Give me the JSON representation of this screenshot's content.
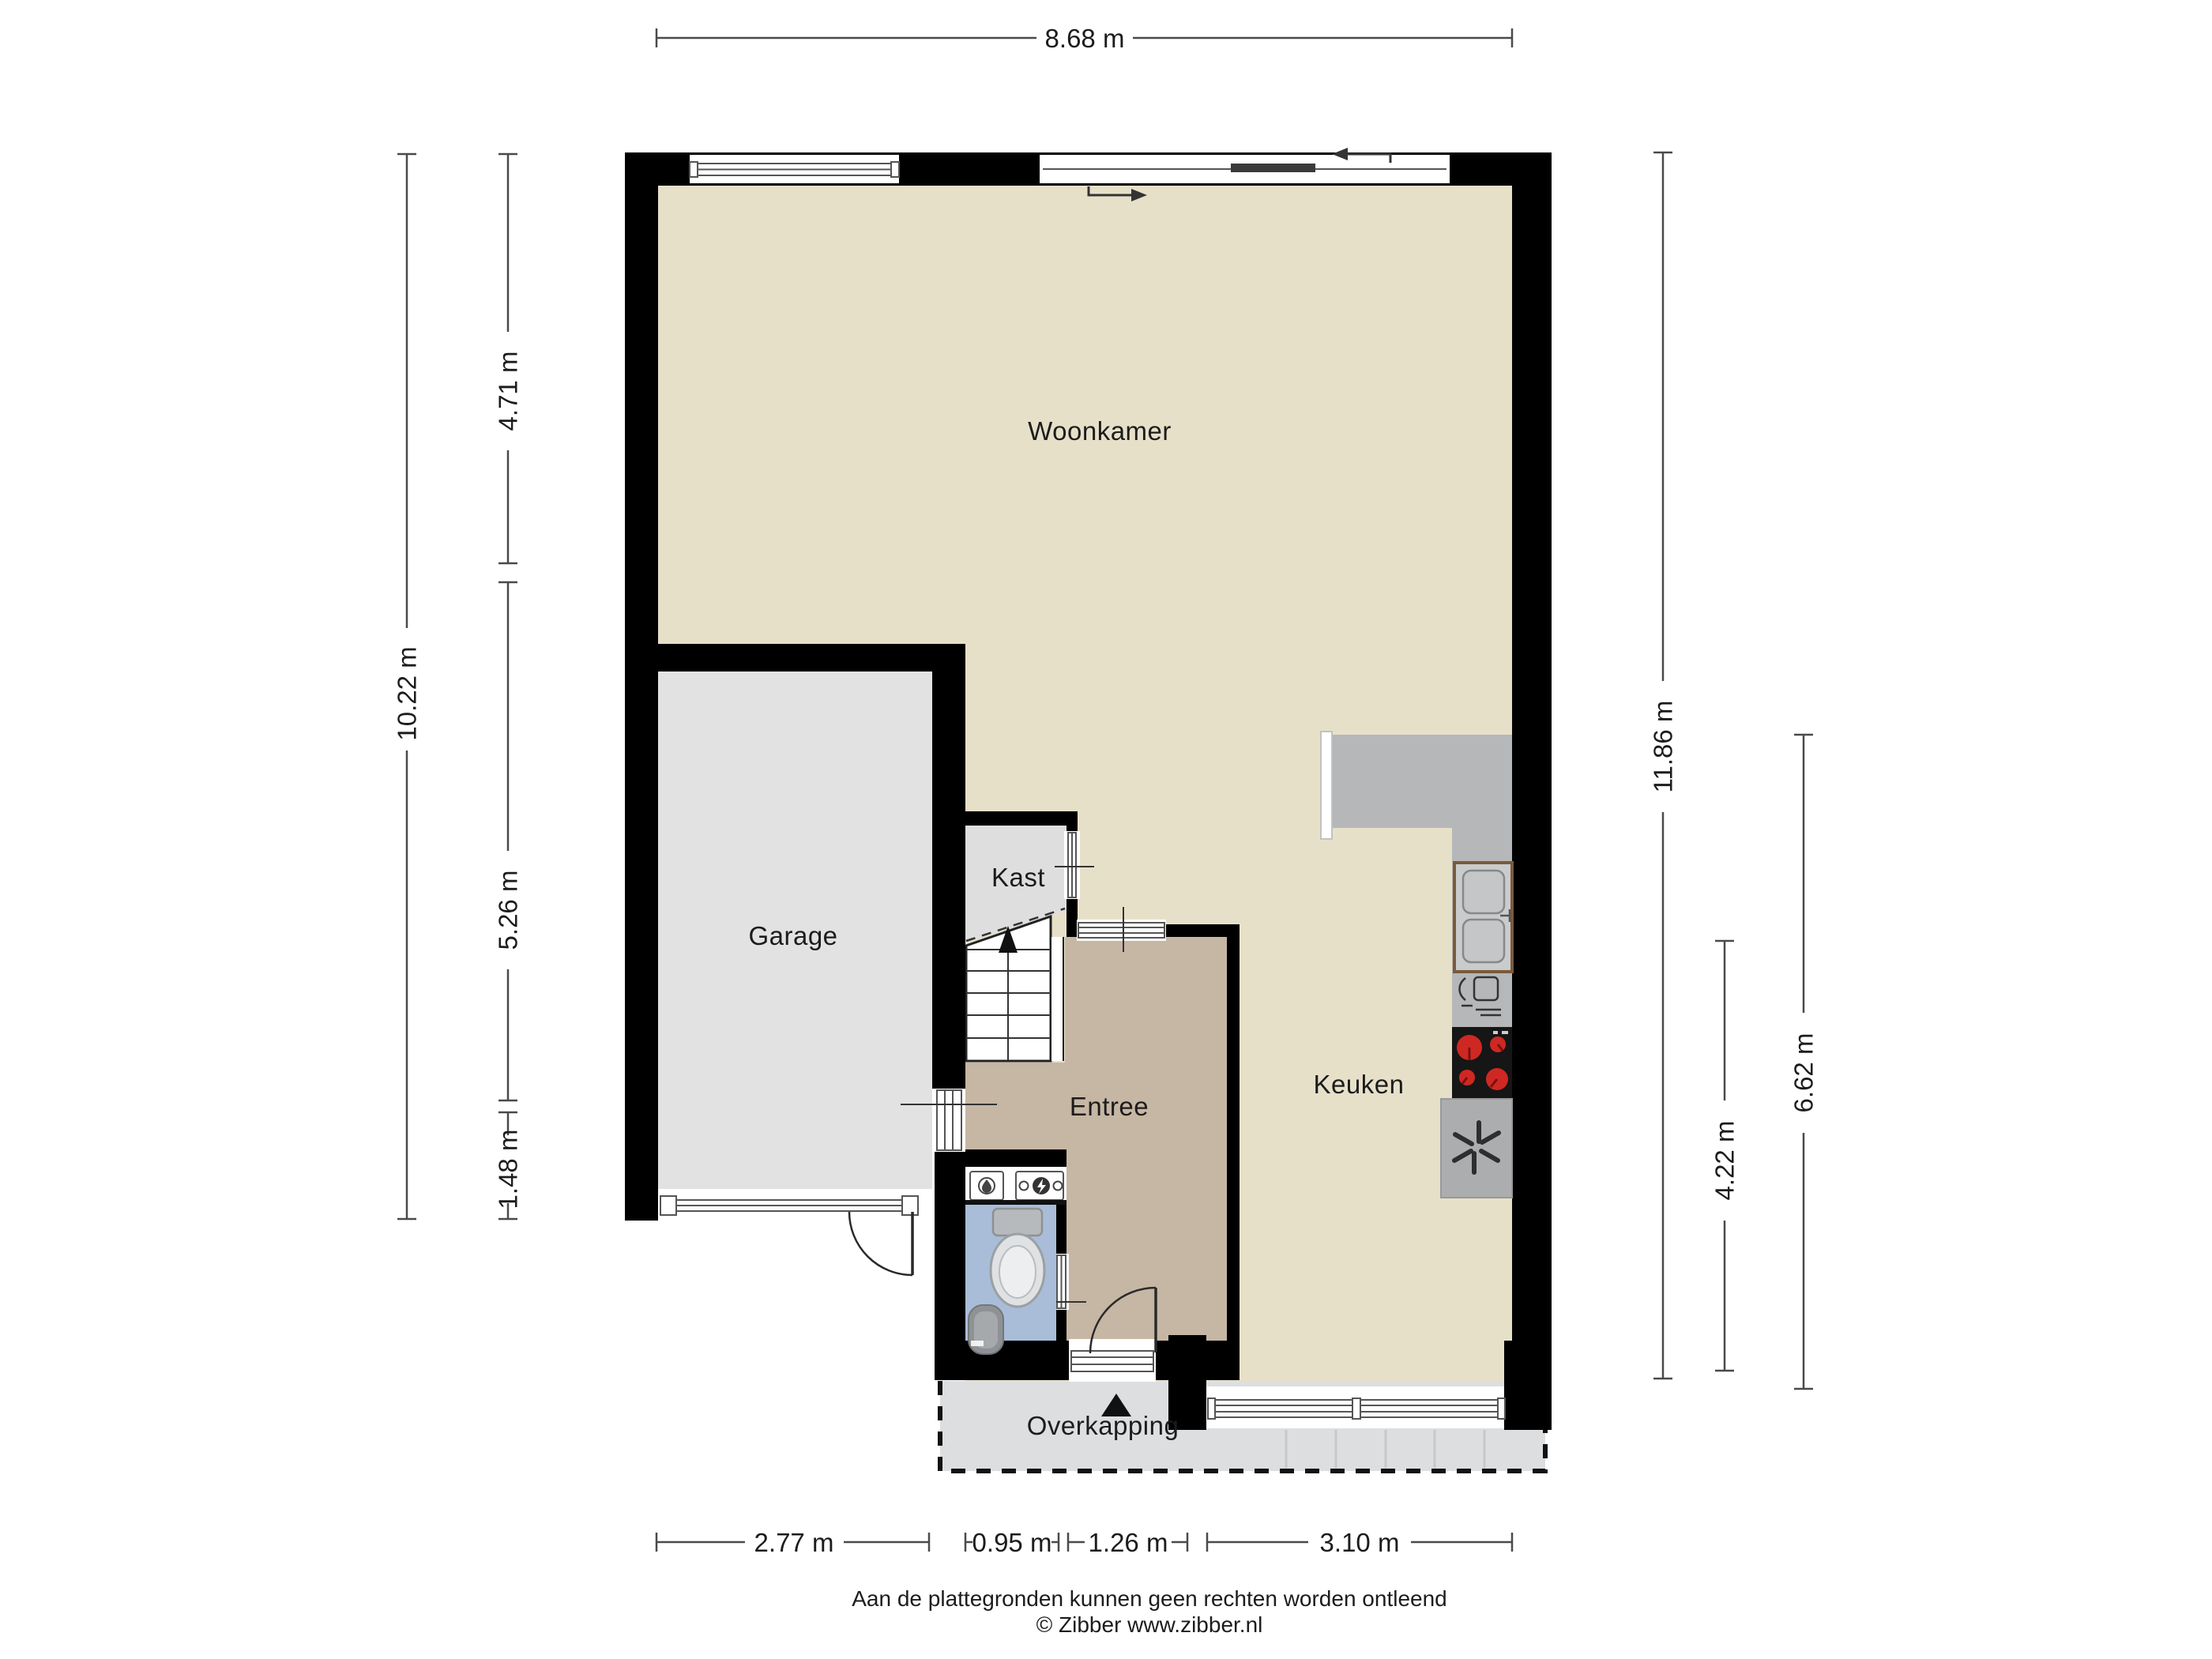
{
  "plan": {
    "rooms": {
      "woonkamer": "Woonkamer",
      "garage": "Garage",
      "kast": "Kast",
      "entree": "Entree",
      "keuken": "Keuken",
      "overkapping": "Overkapping"
    },
    "dimensions": {
      "top_width": "8.68 m",
      "left_total": "10.22 m",
      "left_upper": "4.71 m",
      "left_middle": "5.26 m",
      "left_lower": "1.48 m",
      "right_total": "11.86 m",
      "right_kitchen": "6.62 m",
      "right_lower": "4.22 m",
      "bottom_garage": "2.77 m",
      "bottom_toilet": "0.95 m",
      "bottom_entrance": "1.26 m",
      "bottom_kitchen": "3.10 m"
    },
    "footer": {
      "disclaimer": "Aan de plattegronden kunnen geen rechten worden ontleend",
      "copyright": "© Zibber www.zibber.nl"
    },
    "colors": {
      "wall": "#000000",
      "floor_main": "#e7e0c9",
      "floor_garage": "#e2e2e2",
      "floor_kast": "#dedede",
      "floor_entree": "#c6b6a4",
      "floor_toilet": "#a9bdd8",
      "overkapping": "#dcdee0",
      "counter": "#b5b7b9",
      "appliance": "#abadaf",
      "stove": "#161616",
      "burner": "#cf2823"
    }
  }
}
